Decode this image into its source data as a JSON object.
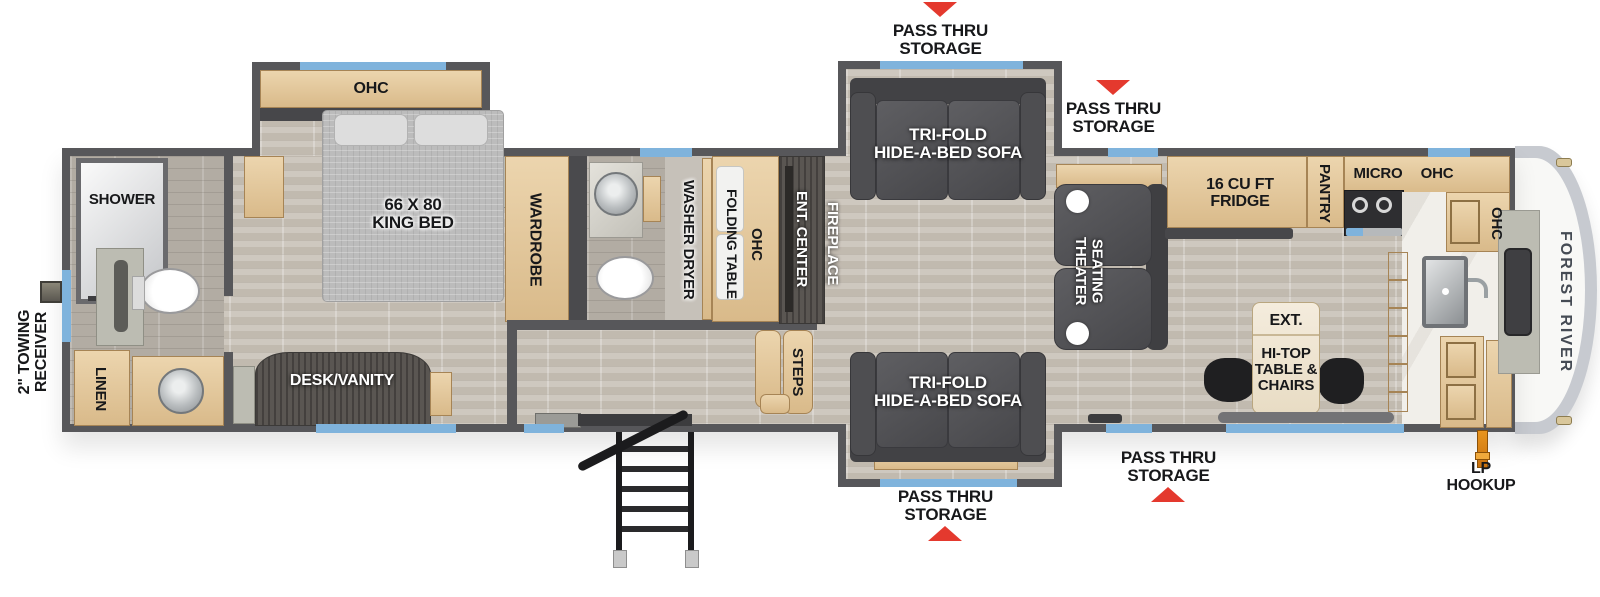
{
  "plan": {
    "brand": "FOREST RIVER",
    "towing_receiver": "2\" TOWING\nRECEIVER",
    "lp_hookup": "LP\nHOOKUP",
    "pass_thru_storage": "PASS THRU\nSTORAGE",
    "shower": "SHOWER",
    "linen": "LINEN",
    "king_bed": "66 X 80\nKING BED",
    "bedroom_ohc": "OHC",
    "desk_vanity": "DESK/VANITY",
    "wardrobe": "WARDROBE",
    "washer_dryer": "WASHER DRYER",
    "folding_table": "FOLDING TABLE",
    "hall_ohc": "OHC",
    "ent_center": "ENT. CENTER",
    "fireplace": "FIREPLACE",
    "steps": "STEPS",
    "trifold_sofa": "TRI-FOLD\nHIDE-A-BED SOFA",
    "theater_seating": "THEATER\nSEATING",
    "fridge": "16 CU FT\nFRIDGE",
    "pantry": "PANTRY",
    "micro": "MICRO",
    "kitchen_ohc_top": "OHC",
    "kitchen_ohc_right": "OHC",
    "ext_table": "EXT.",
    "hitop_table": "HI-TOP\nTABLE &\nCHAIRS"
  }
}
